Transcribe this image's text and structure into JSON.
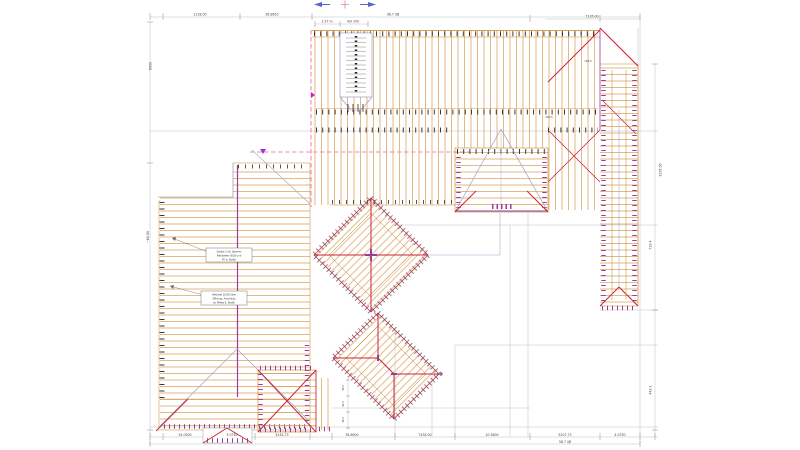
{
  "dims": {
    "top": {
      "seg1": "1128.00",
      "seg2": "36.8610",
      "shaft1": "1.97 m",
      "shaft2": "4/0 100",
      "right": "7135.00",
      "total": "98.7 l/B"
    },
    "bottom": {
      "seg1": "34.0500",
      "seg2": "3.0750",
      "seg3": "5245.73",
      "seg4": "36.8900",
      "seg5": "7434.00",
      "seg6": "10.5600",
      "seg7": "5207.73",
      "seg8": "4.0750",
      "total": "58.7 l/B"
    },
    "left": {
      "seg1": "6000",
      "seg2": "~60.00"
    },
    "right": {
      "seg1": "3135.00",
      "seg2": "733.4",
      "seg3": "443.1"
    }
  },
  "labels": {
    "purlin": "146.5",
    "valley": "140.5",
    "pyr1": "38.5",
    "pyr2": "42.0",
    "pyr3": "36.2"
  },
  "notes": {
    "note1": {
      "l1": "Gaube 1 üb. Sparren",
      "l2": "Kehlbalken 8/18 und",
      "l3": "Pf. lt. Statik"
    },
    "note2": {
      "l1": "Wechsel 10/20 über",
      "l2": "Öffnung, Anschluss",
      "l3": "an Pfette lt. Statik"
    }
  },
  "colors": {
    "rafter": "#dca768",
    "hip": "#cc2233",
    "plate": "#993d99",
    "construction": "#9aa0c8",
    "boundary_dashed": "#ef8fae",
    "dimension": "#999999"
  }
}
